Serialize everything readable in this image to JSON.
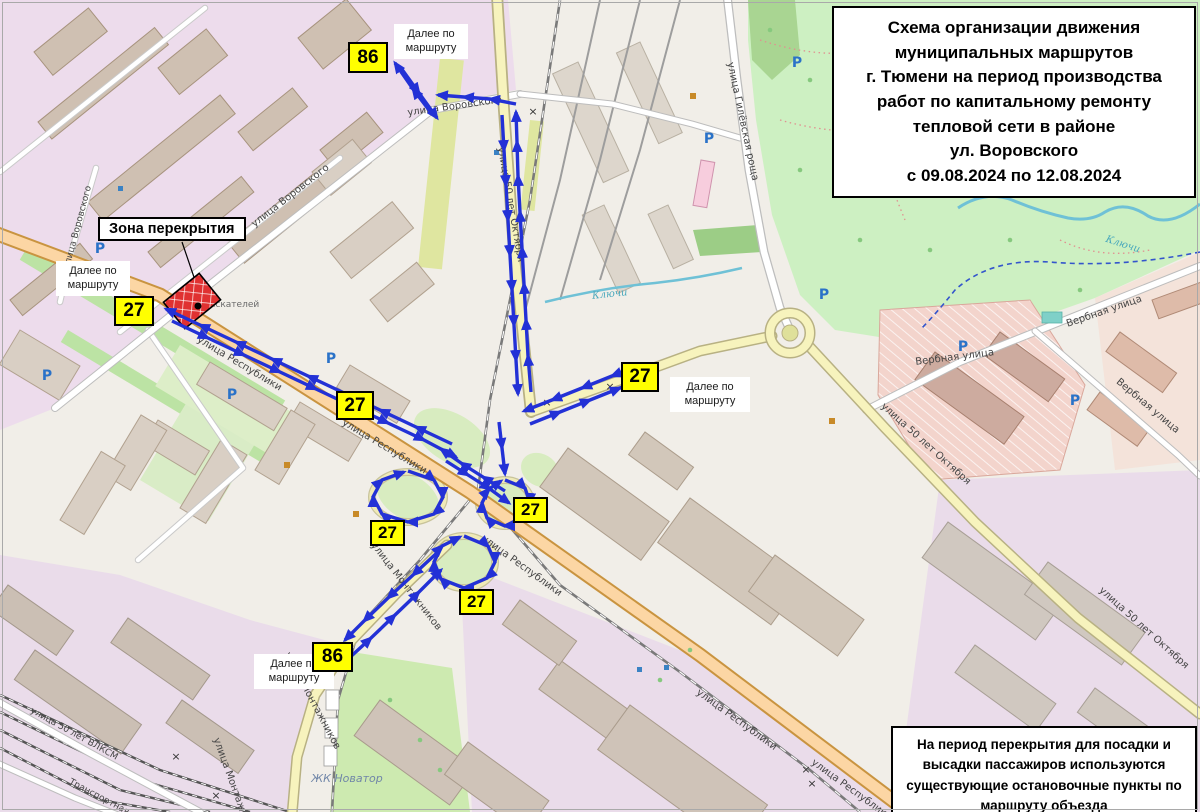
{
  "title_box": {
    "lines": [
      "Схема организации движения",
      "муниципальных маршрутов",
      "г. Тюмени на период производства",
      "работ по капитальному ремонту",
      "тепловой сети в районе",
      "ул. Воровского",
      "с 09.08.2024 по 12.08.2024"
    ]
  },
  "info_box": {
    "lines": [
      "На период перекрытия для посадки и",
      "высадки пассажиров используются",
      "существующие остановочные пункты по",
      "маршруту объезда"
    ]
  },
  "closure_label": "Зона перекрытия",
  "next_label": "Далее по маршруту",
  "badges": {
    "top86": "86",
    "left27": "27",
    "mid27": "27",
    "right27": "27",
    "center27": "27",
    "centerLeft27": "27",
    "lower27": "27",
    "bottom86": "86"
  },
  "streets": {
    "respubliki": "улица Республики",
    "montazhnikov": "улица Монтажников",
    "oktyabrya": "улица 50 лет Октября",
    "vorovskogo": "улица Воровского",
    "gilevskaya": "улица Гилёвская роща",
    "verbnaya": "Вербная улица",
    "vlksm": "улица 50 лет ВЛКСМ",
    "transportnaya": "Транспортная",
    "novator": "ЖК Новатор",
    "klyuchi": "Ключи",
    "izyskateley": "Изыскателей",
    "parking": "P",
    "crossing": "×"
  },
  "colors": {
    "route_arrow": "#2331d6",
    "badge_bg": "#ffff00",
    "closure_red": "#d7263d",
    "primary_road": "#fcd6a4",
    "secondary_road": "#f7f3bd",
    "park_green": "#cdf0c2"
  }
}
